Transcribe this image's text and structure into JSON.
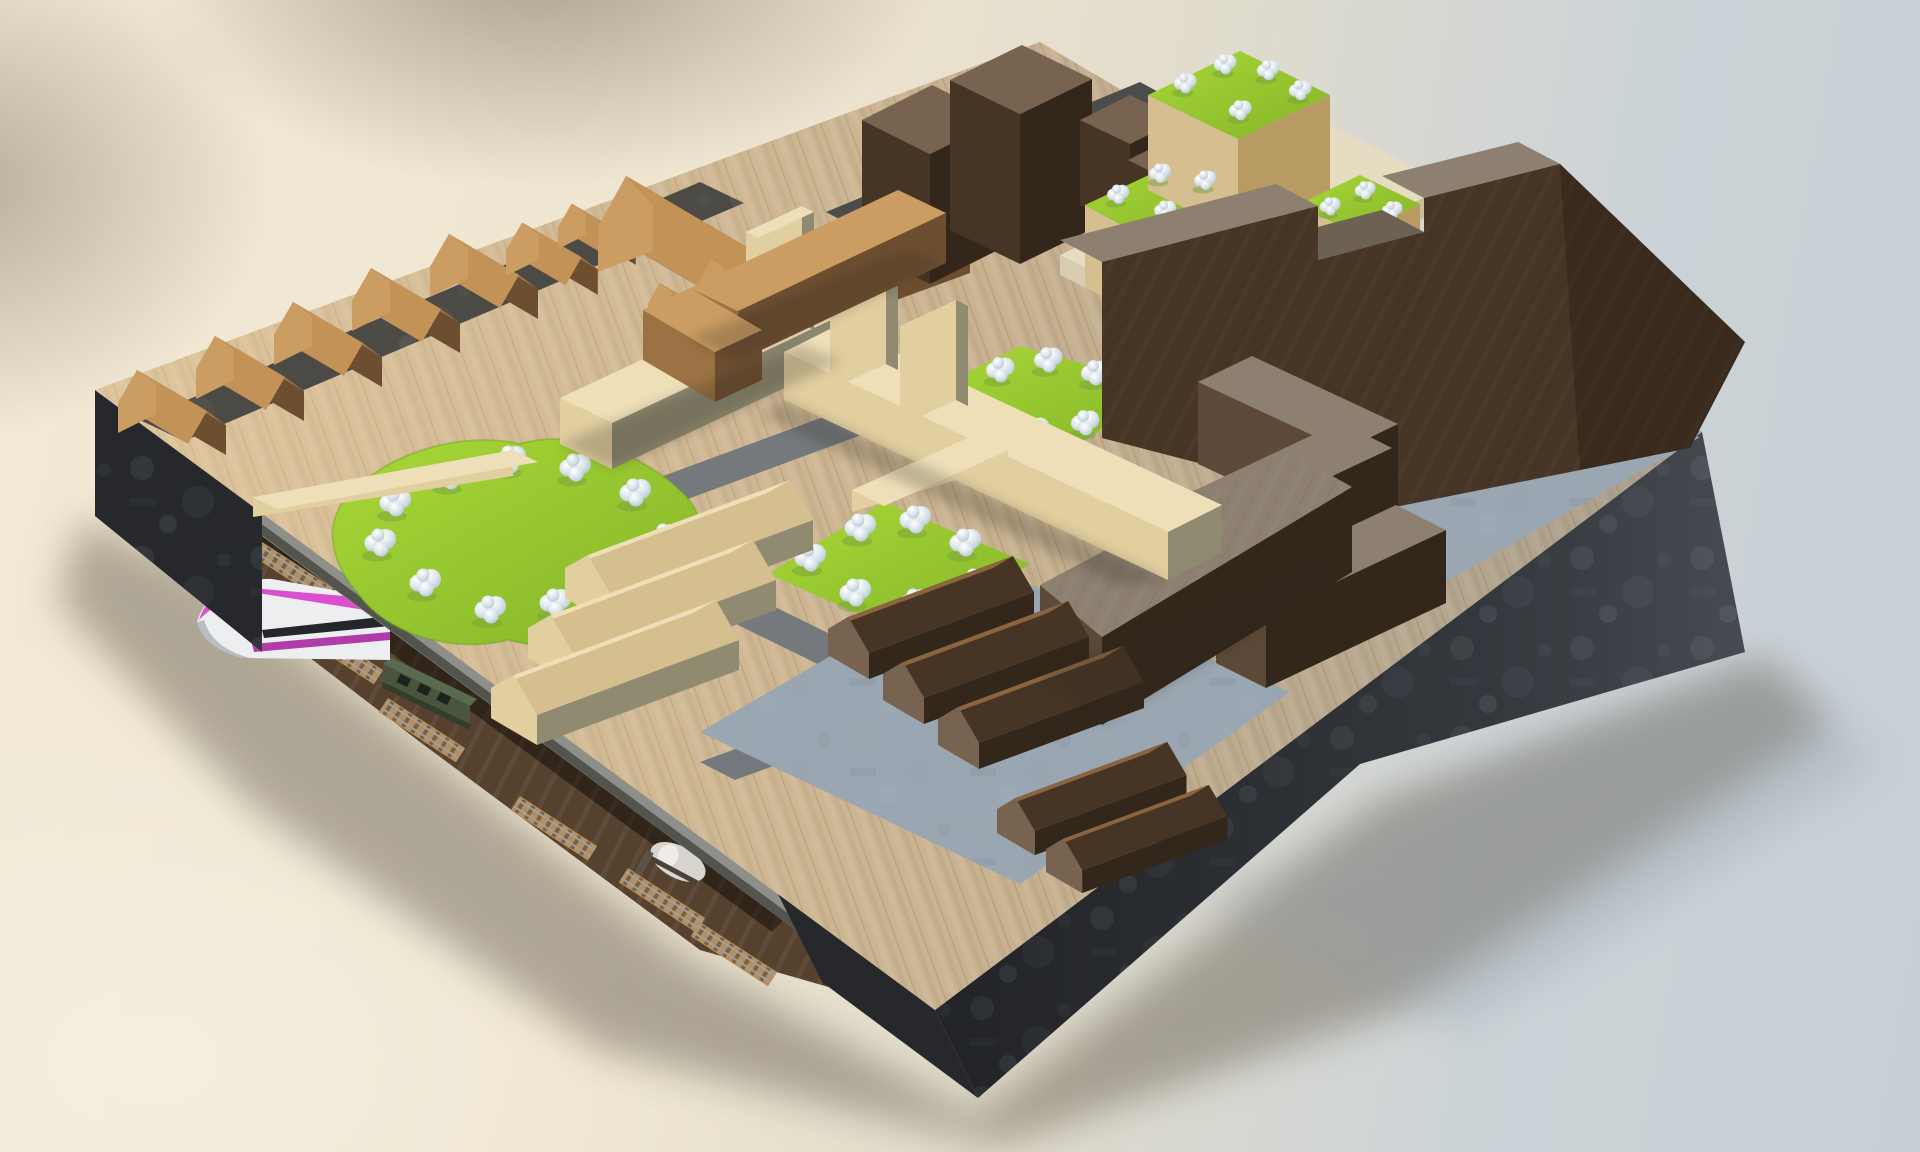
{
  "image": {
    "kind": "3d-architectural-model-render",
    "subject": "isometric wooden city-block diorama on a dark plinth, studio backdrop",
    "notable_parts": [
      "gabled-house-row-northwest",
      "l-shaped-gabled-building",
      "dark-tower-blocks",
      "terraced-building-with-grass-roofs",
      "castellated-slab-building-northeast",
      "zigzag-slab-buildings",
      "triangular-slab-building",
      "beige-bar-buildings",
      "light-gabled-house-row",
      "dark-gabled-house-rows",
      "organic-lawn-with-white-trees",
      "square-park-center",
      "square-park-upper",
      "cantilevered-deck-edge",
      "underground-rail-level",
      "pink-highspeed-train",
      "green-railcar",
      "white-tanker-car",
      "railway-track-segments",
      "charcoal-plinth-sides"
    ]
  },
  "colors": {
    "wood_top": "#c9b290",
    "path_grey": "#75797d",
    "plaza_blue": "#9aa7b2",
    "charcoal": "#26282c",
    "charcoal_light": "#45494e",
    "brown_floor": "#55412e",
    "beige_top": "#eedfb8",
    "beige_lit": "#e2cfa0",
    "beige_face": "#d6bf8f",
    "beige_dark": "#8f8a70",
    "oak_top": "#cb9d63",
    "oak_lit": "#c39257",
    "oak_shadow": "#9b7244",
    "oak_dark": "#6e4e30",
    "walnut_top": "#786250",
    "walnut_lit": "#8a6540",
    "walnut_face": "#463424",
    "walnut_dark": "#33261a",
    "slab_top": "#8d8071",
    "slab_face": "#5c4937",
    "grass": "#a8d838",
    "grass_dark": "#84b427",
    "tree_hi": "#ffffff",
    "tree_mid": "#dce5ec",
    "tree_shadow": "#b6c8d4",
    "deck_grey": "#8e8e8a",
    "train_pink": "#d94fce",
    "train_pink_dark": "#b13ba8",
    "train_white": "#eceef0",
    "train_green": "#49563e",
    "train_green_dark": "#333d2c",
    "track_tan": "#b39061",
    "sleeper": "#7e5f3e",
    "rail": "#9aa0a5",
    "ground_shadow": "#6e6557"
  }
}
